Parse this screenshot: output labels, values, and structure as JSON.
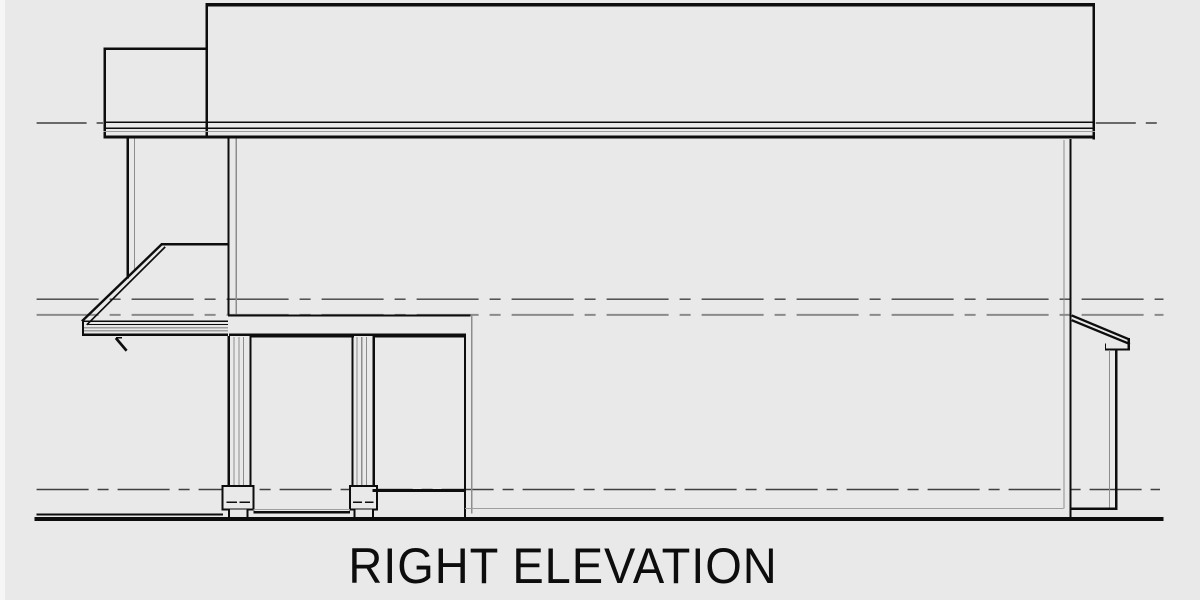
{
  "title": {
    "label": "RIGHT ELEVATION"
  },
  "colors": {
    "background": "#e9e9e9",
    "page_edge": "#f6f6f6",
    "ink": "#0d0d0d",
    "muted": "#8d8d8d",
    "muted_light": "#9e9e9e",
    "dash_dark": "#3f3f3f",
    "dash_gray": "#8a8a8a"
  },
  "drawing": {
    "kind": "architectural elevation line drawing",
    "parts": [
      "upper-roof",
      "roof-step",
      "roof-fascia",
      "second-floor-porch-post",
      "porch-shed-roof",
      "shed-roof-bracket",
      "upper-floor-band",
      "porch-column",
      "column-base",
      "porch-opening",
      "first-floor-wall-corner",
      "right-wall",
      "rear-awning",
      "awning-post",
      "grade-line",
      "level-reference-lines"
    ]
  }
}
